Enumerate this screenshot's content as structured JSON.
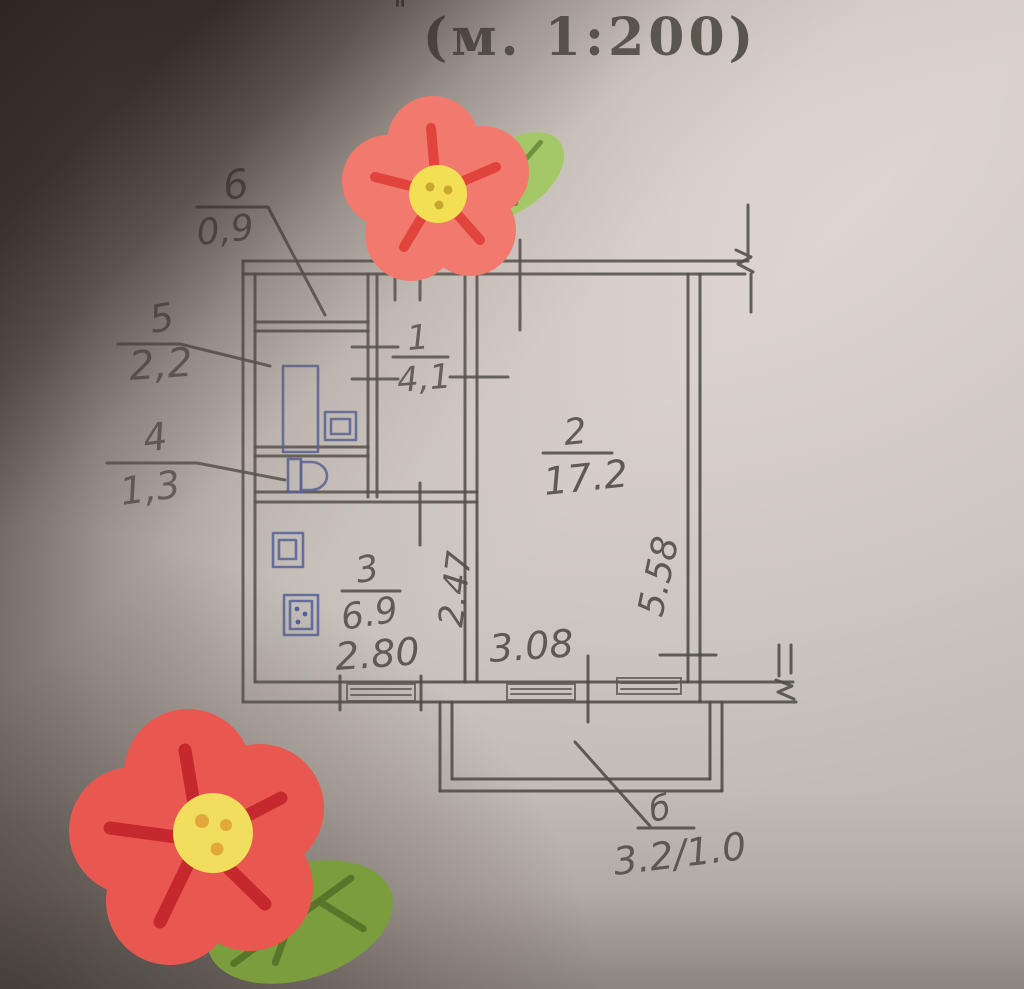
{
  "title": {
    "scale_text": "(м. 1:200)",
    "ditto_mark": "\""
  },
  "callouts": [
    {
      "number": "6",
      "value": "0,9"
    },
    {
      "number": "5",
      "value": "2,2"
    },
    {
      "number": "4",
      "value": "1,3"
    }
  ],
  "rooms": [
    {
      "number": "1",
      "area": "4,1"
    },
    {
      "number": "2",
      "area": "17.2"
    },
    {
      "number": "3",
      "area": "6.9"
    }
  ],
  "dimensions": {
    "kitchen_width": "2.80",
    "room_width": "3.08",
    "kitchen_depth": "2.47",
    "room_depth": "5.58"
  },
  "balcony": {
    "label": "б",
    "area_text": "3.2/1.0"
  },
  "colors": {
    "paper": "#d7d1ca",
    "pencil": "#4f4b46",
    "ink_blue": "#4d5c9c",
    "flower_petal_top": "#F1796E",
    "flower_petal_bottom": "#E95850",
    "flower_spoke": "#E0443C",
    "flower_center": "#F2DF54",
    "leaf_green": "#9DC163",
    "leaf_vein": "#6D9140"
  }
}
